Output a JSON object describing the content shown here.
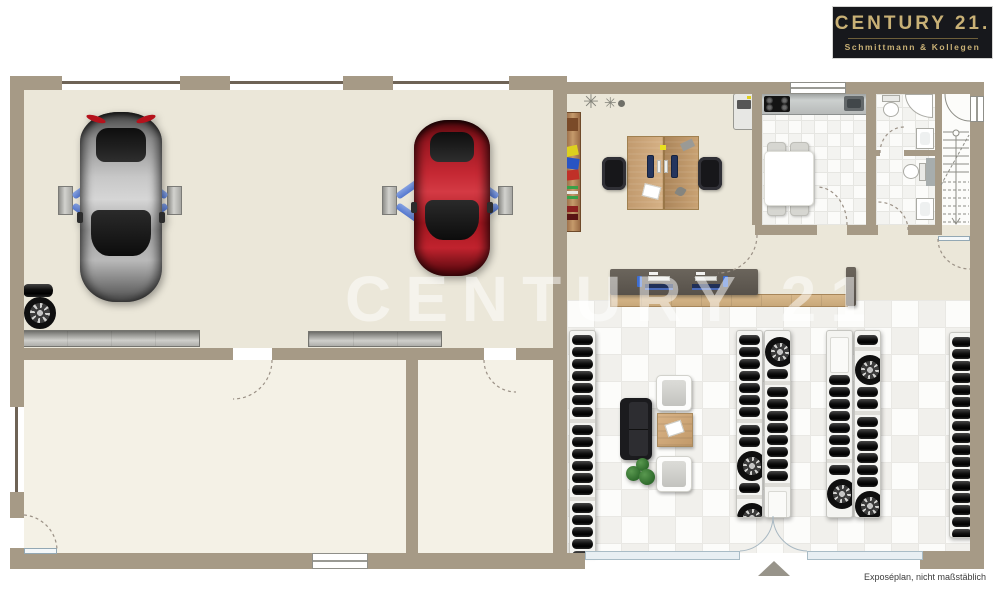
{
  "branding": {
    "title": "CENTURY 21.",
    "subtitle": "Schmittmann & Kollegen"
  },
  "watermark": {
    "text": "CENTURY 21"
  },
  "footer": {
    "disclaimer": "Exposéplan, nicht maßstäblich"
  },
  "palette": {
    "wall": "#a69a86",
    "wall_dark": "#6e6356",
    "floor_workshop": "#ebe7d9",
    "floor_room": "#f4f1e6",
    "tile_light": "#fcfcfa",
    "tile_dark": "#f1f0ec",
    "glass": "#e8eff3",
    "glass_frame": "#a9bcc6",
    "counter_dark": "#57514a",
    "wood": "#c8a87a",
    "logo_bg": "#17181c",
    "logo_gold": "#c9b176",
    "lift_blue": "#5578cf",
    "plant": "#2f6b2c"
  },
  "tire_racks": [
    {
      "id": "rack-left-wall",
      "x": 569,
      "y": 330,
      "w": 27,
      "h": 225,
      "items": [
        "t",
        "t",
        "t",
        "t",
        "t",
        "t",
        "t",
        "g",
        "t",
        "t",
        "t",
        "t",
        "t",
        "t",
        "g",
        "t",
        "t",
        "t",
        "t",
        "t",
        "t"
      ]
    },
    {
      "id": "rack-mid-a1",
      "x": 736,
      "y": 330,
      "w": 27,
      "h": 188,
      "items": [
        "t",
        "t",
        "t",
        "t",
        "t",
        "t",
        "t",
        "g",
        "t",
        "t",
        "w",
        "t",
        "g",
        "w"
      ]
    },
    {
      "id": "rack-mid-a2",
      "x": 764,
      "y": 330,
      "w": 27,
      "h": 188,
      "items": [
        "w",
        "t",
        "g",
        "t",
        "t",
        "t",
        "t",
        "t",
        "t",
        "t",
        "t",
        "g",
        "e"
      ]
    },
    {
      "id": "rack-mid-b1",
      "x": 826,
      "y": 330,
      "w": 27,
      "h": 188,
      "items": [
        "e",
        "t",
        "t",
        "t",
        "t",
        "t",
        "t",
        "t",
        "g",
        "t",
        "w"
      ]
    },
    {
      "id": "rack-mid-b2",
      "x": 854,
      "y": 330,
      "w": 27,
      "h": 188,
      "items": [
        "t",
        "g",
        "w",
        "t",
        "t",
        "g",
        "t",
        "t",
        "t",
        "t",
        "t",
        "t",
        "w"
      ]
    },
    {
      "id": "rack-right-wall",
      "x": 949,
      "y": 332,
      "w": 26,
      "h": 206,
      "items": [
        "t",
        "t",
        "t",
        "t",
        "t",
        "t",
        "t",
        "t",
        "t",
        "t",
        "t",
        "t",
        "t",
        "t",
        "t",
        "t",
        "t",
        "t"
      ]
    }
  ]
}
